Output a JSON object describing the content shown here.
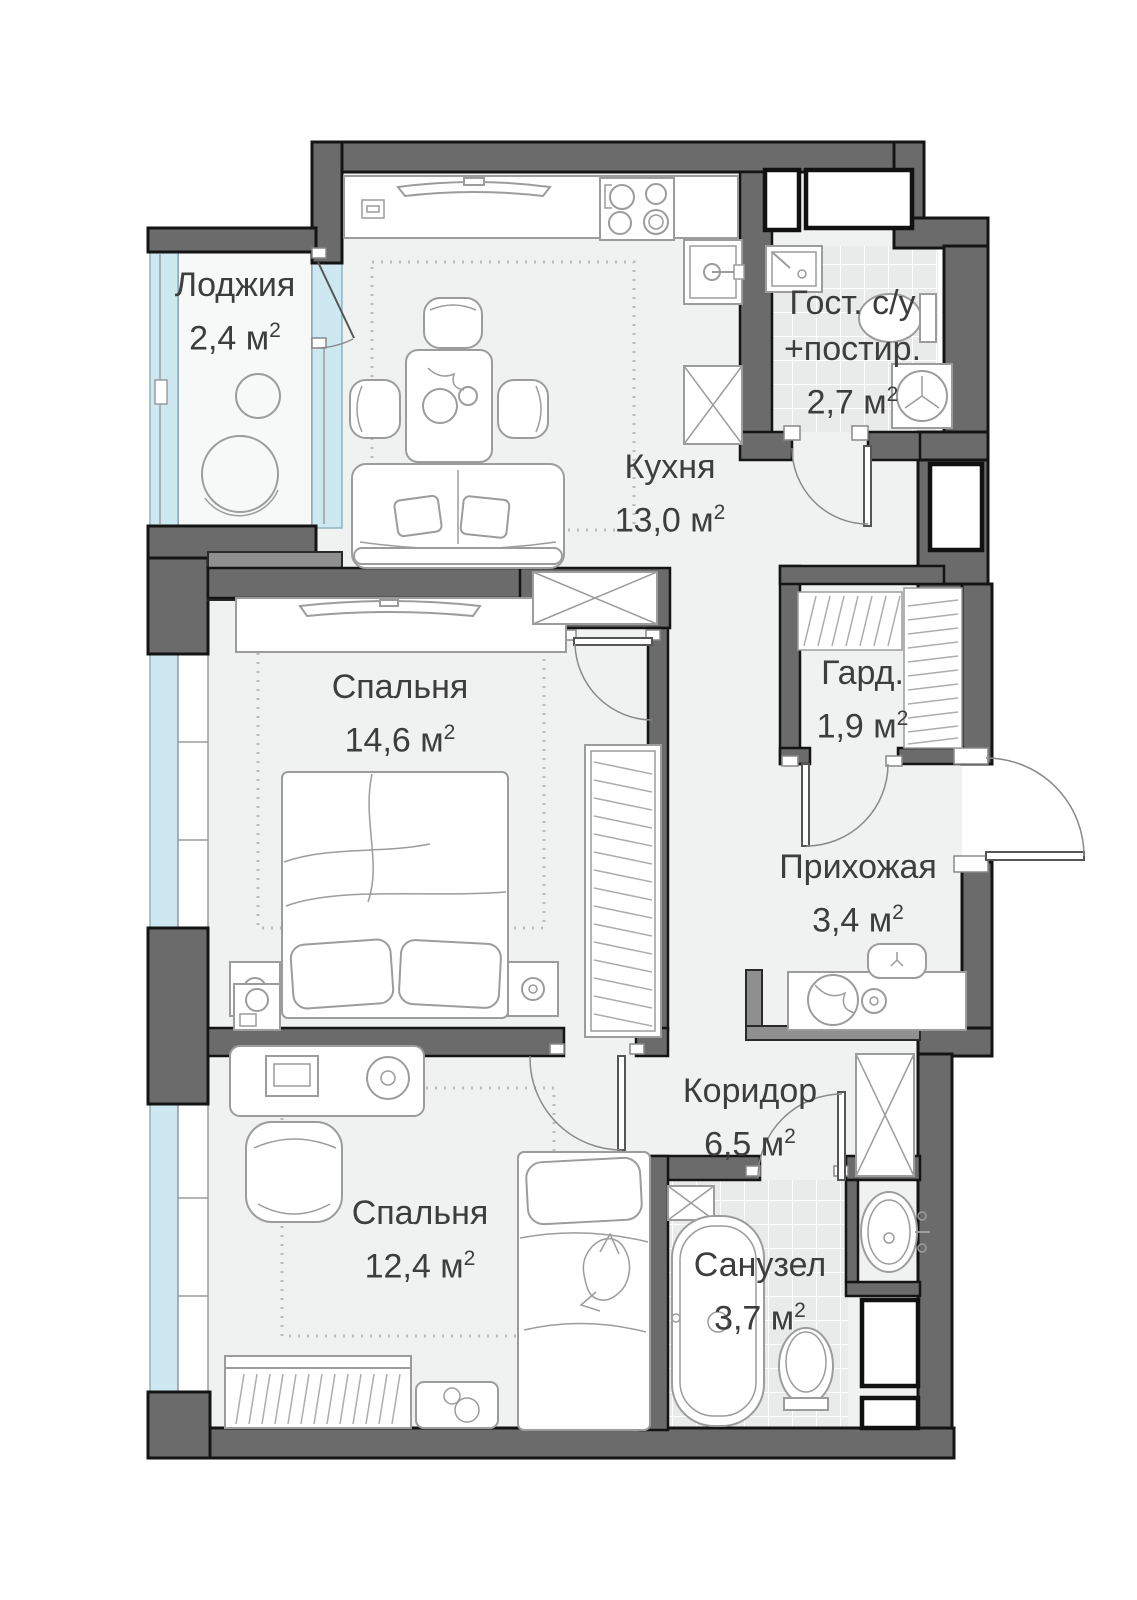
{
  "colors": {
    "wall": "#6b6b6b",
    "wall_light": "#8f8f8f",
    "outline": "#141414",
    "glazing": "#cde8f0",
    "floor": "#f0f1f1",
    "floor_loggia": "#f7f8f8",
    "tile": "#e9eaea",
    "furniture_line": "#9c9c9c",
    "text": "#3d3d3d"
  },
  "rooms": {
    "loggia": {
      "name": "Лоджия",
      "area": "2,4 м",
      "sup": "2"
    },
    "kitchen": {
      "name": "Кухня",
      "area": "13,0 м",
      "sup": "2"
    },
    "guest_bath": {
      "name": "Гост. с/у",
      "name2": "+постир.",
      "area": "2,7 м",
      "sup": "2"
    },
    "wardrobe": {
      "name": "Гард.",
      "area": "1,9 м",
      "sup": "2"
    },
    "bedroom1": {
      "name": "Спальня",
      "area": "14,6 м",
      "sup": "2"
    },
    "hallway": {
      "name": "Прихожая",
      "area": "3,4 м",
      "sup": "2"
    },
    "corridor": {
      "name": "Коридор",
      "area": "6,5 м",
      "sup": "2"
    },
    "bedroom2": {
      "name": "Спальня",
      "area": "12,4 м",
      "sup": "2"
    },
    "bathroom": {
      "name": "Санузел",
      "area": "3,7 м",
      "sup": "2"
    }
  }
}
